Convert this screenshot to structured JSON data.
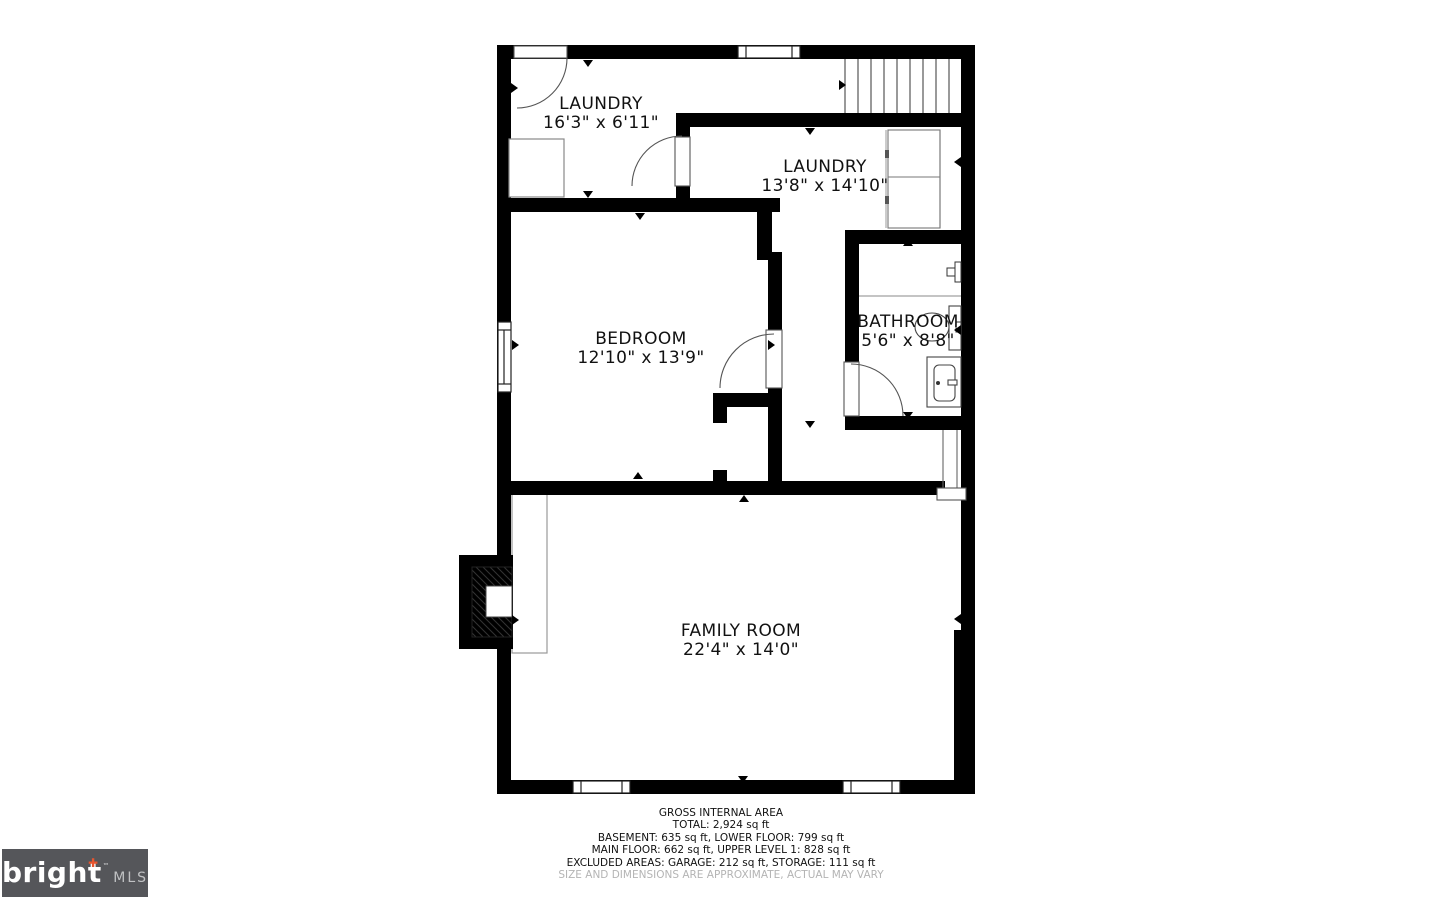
{
  "rooms": {
    "laundry1": {
      "name": "LAUNDRY",
      "dims": "16'3\" x 6'11\""
    },
    "laundry2": {
      "name": "LAUNDRY",
      "dims": "13'8\" x 14'10\""
    },
    "bedroom": {
      "name": "BEDROOM",
      "dims": "12'10\" x 13'9\""
    },
    "bathroom": {
      "name": "BATHROOM",
      "dims": "5'6\" x 8'8\""
    },
    "family_room": {
      "name": "FAMILY ROOM",
      "dims": "22'4\" x 14'0\""
    }
  },
  "footer": {
    "line1": "GROSS INTERNAL AREA",
    "line2": "TOTAL: 2,924 sq ft",
    "line3": "BASEMENT: 635 sq ft, LOWER FLOOR: 799 sq ft",
    "line4": "MAIN FLOOR: 662 sq ft, UPPER LEVEL 1: 828 sq ft",
    "line5": "EXCLUDED AREAS: GARAGE: 212 sq ft, STORAGE: 111 sq ft",
    "disclaimer": "SIZE AND DIMENSIONS ARE APPROXIMATE, ACTUAL MAY VARY"
  },
  "logo": {
    "brand": "bright",
    "tm": "™",
    "suffix": "MLS"
  },
  "icons": {
    "logo_plus": "✚"
  },
  "colors": {
    "wall": "#000000",
    "thin_line": "#666666",
    "label_text": "#111111",
    "muted_text": "#b4b4b4",
    "logo_bg": "#55565a",
    "accent": "#e8552f"
  }
}
